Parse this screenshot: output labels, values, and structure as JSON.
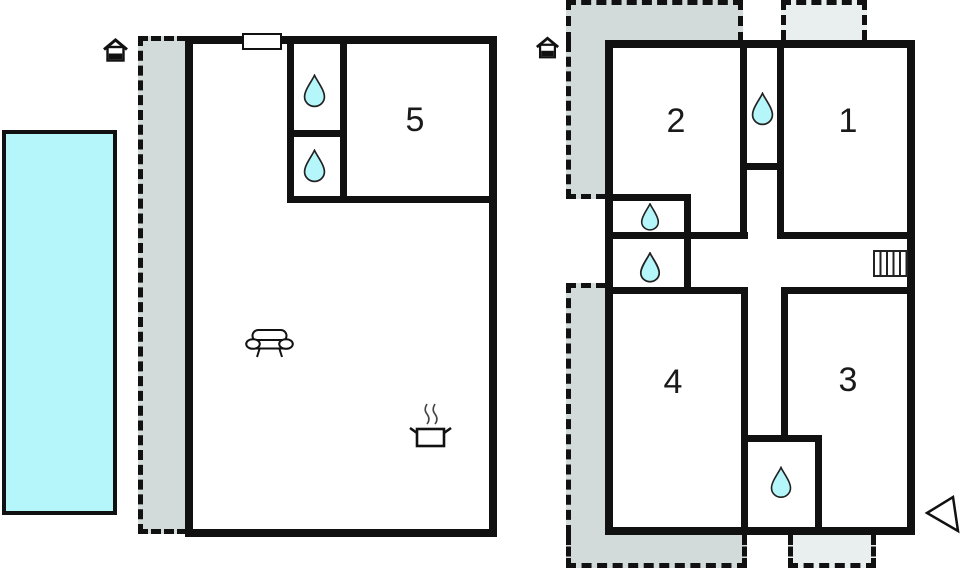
{
  "plan": {
    "type": "holiday-home floor plan",
    "colors": {
      "wall": "#111111",
      "water": "#b5f6fa",
      "terrace": "#d3dada",
      "terrace_light": "#e9eeee",
      "background": "#ffffff"
    },
    "ground_floor": {
      "rooms": [
        {
          "id": "room-5",
          "label": "5"
        }
      ],
      "icons": [
        "house-entrance-icon",
        "window-marker",
        "water-drop-icon",
        "water-drop-icon",
        "sofa-icon",
        "cooking-pot-icon"
      ],
      "outdoor": [
        "pool",
        "covered-terrace"
      ]
    },
    "upper_floor": {
      "rooms": [
        {
          "id": "room-2",
          "label": "2"
        },
        {
          "id": "room-1",
          "label": "1"
        },
        {
          "id": "room-4",
          "label": "4"
        },
        {
          "id": "room-3",
          "label": "3"
        }
      ],
      "icons": [
        "house-entrance-icon",
        "water-drop-icon",
        "water-drop-icon",
        "water-drop-icon",
        "water-drop-icon",
        "stairs-icon",
        "north-arrow-icon"
      ],
      "outdoor": [
        "covered-terrace-top",
        "covered-terrace-bottom",
        "open-terrace-top",
        "open-terrace-bottom"
      ]
    }
  }
}
